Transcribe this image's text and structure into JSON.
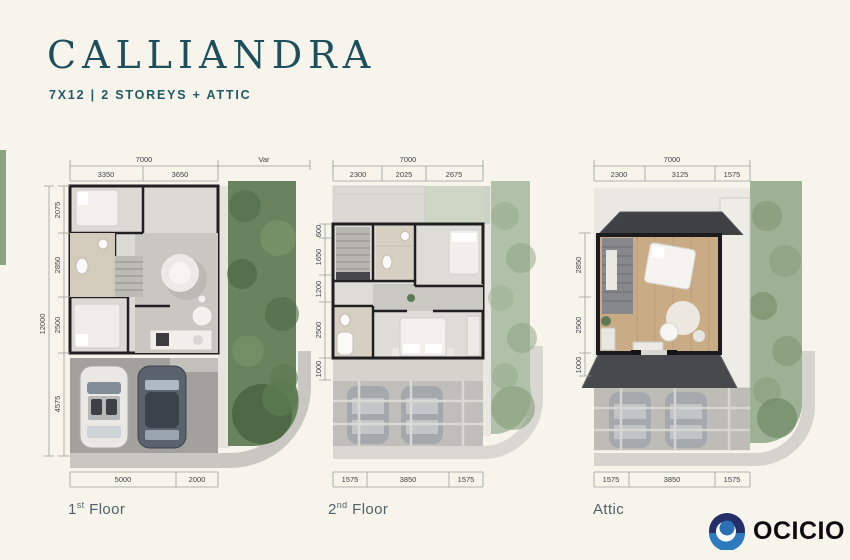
{
  "header": {
    "title": "CALLIANDRA",
    "subtitle": "7X12  | 2 STOREYS + ATTIC"
  },
  "plans": [
    {
      "label": {
        "num": "1",
        "sup": "st",
        "rest": " Floor"
      },
      "dims": {
        "top_total": "7000",
        "var_label": "Var",
        "top": [
          "3350",
          "3650"
        ],
        "left_total": "12000",
        "left": [
          "2075",
          "2850",
          "2500",
          "4575"
        ],
        "bottom": [
          "5000",
          "2000"
        ]
      }
    },
    {
      "label": {
        "num": "2",
        "sup": "nd",
        "rest": " Floor"
      },
      "dims": {
        "top_total": "7000",
        "top": [
          "2300",
          "2025",
          "2675"
        ],
        "left": [
          "600",
          "1650",
          "1200",
          "2500",
          "1000"
        ],
        "bottom": [
          "1575",
          "3850",
          "1575"
        ]
      }
    },
    {
      "label": {
        "num": "",
        "sup": "",
        "rest": "Attic"
      },
      "dims": {
        "top_total": "7000",
        "top": [
          "2300",
          "3125",
          "1575"
        ],
        "left": [
          "2850",
          "2500",
          "1000"
        ],
        "bottom": [
          "1575",
          "3850",
          "1575"
        ]
      }
    }
  ],
  "logo": {
    "text": "OCICIO"
  },
  "colors": {
    "background": "#f7f4ec",
    "accent_teal": "#1d4f5c",
    "greenery": "#68835d",
    "logo_navy": "#252e68",
    "logo_blue": "#2d7abe"
  }
}
